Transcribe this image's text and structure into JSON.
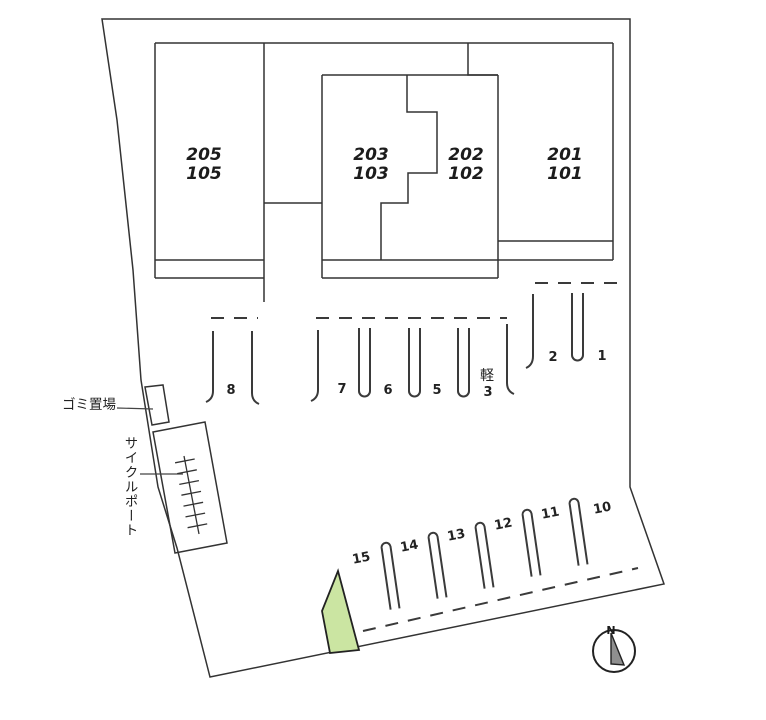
{
  "buildings": [
    {
      "upper": "205",
      "lower": "105"
    },
    {
      "upper": "203",
      "lower": "103"
    },
    {
      "upper": "202",
      "lower": "102"
    },
    {
      "upper": "201",
      "lower": "101"
    }
  ],
  "parking": {
    "upper_right_row": [
      "2",
      "1"
    ],
    "middle_row": [
      "8",
      "7",
      "6",
      "5"
    ],
    "kei": {
      "label": "軽",
      "number": "3"
    },
    "bottom_row": [
      "15",
      "14",
      "13",
      "12",
      "11",
      "10"
    ]
  },
  "labels": {
    "garbage": "ゴミ置場",
    "cycle_port": "サイクルポート"
  },
  "compass": {
    "north": "N"
  },
  "colors": {
    "highlight_green": "#cbe5a2",
    "line": "#333333",
    "background": "#ffffff"
  }
}
